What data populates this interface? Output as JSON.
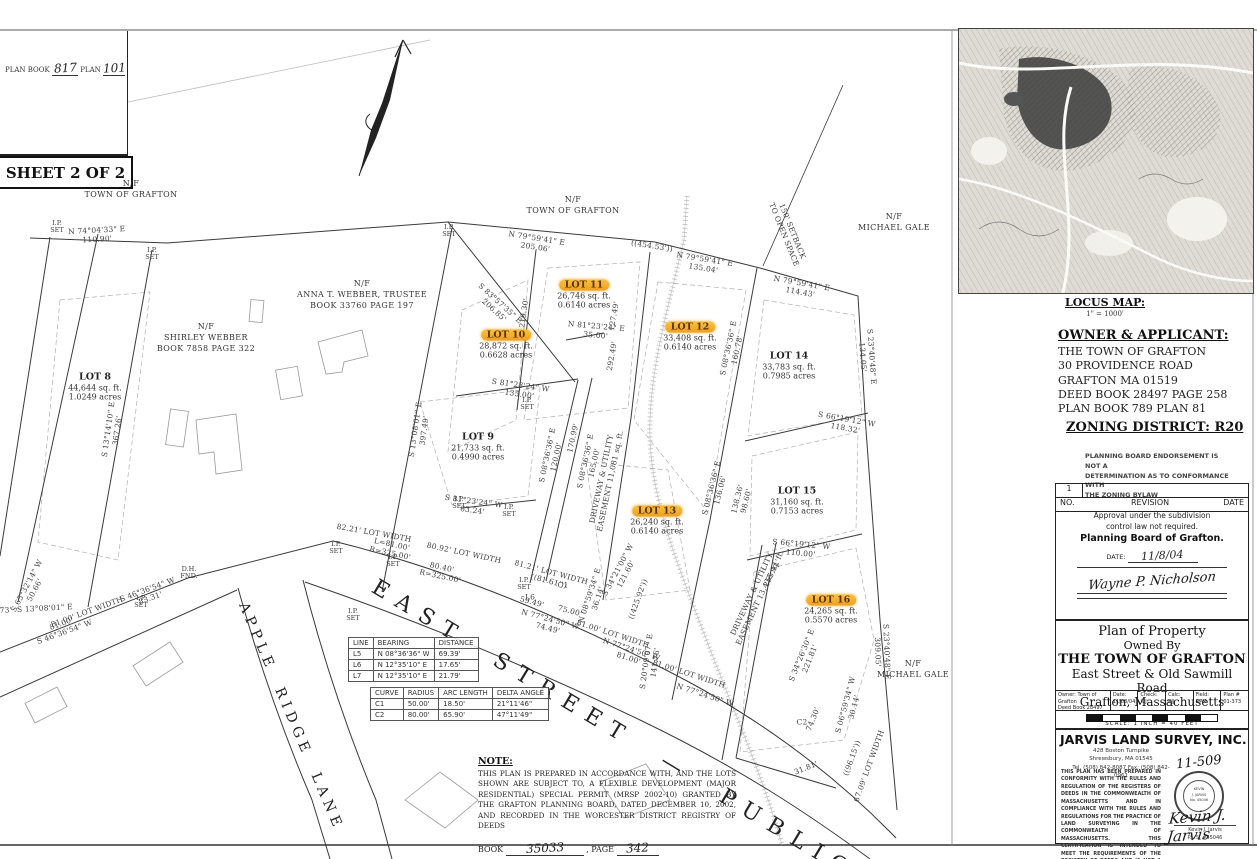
{
  "page": {
    "plan_book_label": "PLAN BOOK",
    "plan_book_value": "817",
    "plan_label": "PLAN",
    "plan_value": "101",
    "sheet_label": "SHEET 2 OF 2"
  },
  "plan": {
    "streets": {
      "east": "EAST  STREET  —  PUBLIC",
      "apple": "APPLE  RIDGE  LANE"
    },
    "lots": [
      {
        "name": "LOT 8",
        "area": "44,644 sq. ft.",
        "acres": "1.0249 acres",
        "hl": false,
        "x": 95,
        "y": 383
      },
      {
        "name": "LOT 9",
        "area": "21,733 sq. ft.",
        "acres": "0.4990 acres",
        "hl": false,
        "x": 478,
        "y": 443
      },
      {
        "name": "LOT 10",
        "area": "28,872 sq. ft.",
        "acres": "0.6628 acres",
        "hl": true,
        "x": 506,
        "y": 341
      },
      {
        "name": "LOT 11",
        "area": "26,746 sq. ft.",
        "acres": "0.6140 acres",
        "hl": true,
        "x": 584,
        "y": 291
      },
      {
        "name": "LOT 12",
        "area": "33,408 sq. ft.",
        "acres": "0.6140 acres",
        "hl": true,
        "x": 690,
        "y": 333
      },
      {
        "name": "LOT 13",
        "area": "26,240 sq. ft.",
        "acres": "0.6140 acres",
        "hl": true,
        "x": 657,
        "y": 517
      },
      {
        "name": "LOT 14",
        "area": "33,783 sq. ft.",
        "acres": "0.7985 acres",
        "hl": false,
        "x": 789,
        "y": 362
      },
      {
        "name": "LOT 15",
        "area": "31,160 sq. ft.",
        "acres": "0.7153 acres",
        "hl": false,
        "x": 797,
        "y": 497
      },
      {
        "name": "LOT 16",
        "area": "24,265 sq. ft.",
        "acres": "0.5570 acres",
        "hl": true,
        "x": 831,
        "y": 606
      }
    ],
    "abutters": [
      {
        "t": "N/F\nTOWN OF GRAFTON",
        "x": 131,
        "y": 190
      },
      {
        "t": "N/F\nTOWN OF GRAFTON",
        "x": 573,
        "y": 206
      },
      {
        "t": "N/F\nMICHAEL GALE",
        "x": 894,
        "y": 223
      },
      {
        "t": "N/F\nANNA T. WEBBER, TRUSTEE\nBOOK 33760 PAGE 197",
        "x": 362,
        "y": 295
      },
      {
        "t": "N/F\nSHIRLEY WEBBER\nBOOK 7858 PAGE 322",
        "x": 206,
        "y": 338
      },
      {
        "t": "N/F\nMICHAEL GALE",
        "x": 913,
        "y": 670
      }
    ],
    "labels": [
      {
        "t": "N 74°04'33\" E\n110.90'",
        "x": 97,
        "y": 235,
        "r": -3
      },
      {
        "t": "N 79°59'41\" E\n205.06'",
        "x": 536,
        "y": 243,
        "r": 9
      },
      {
        "t": "((454.53'))",
        "x": 652,
        "y": 246,
        "r": 9
      },
      {
        "t": "N 79°59'41\" E\n135.04'",
        "x": 704,
        "y": 264,
        "r": 9
      },
      {
        "t": "N 79°59'41\" E\n114.43'",
        "x": 801,
        "y": 288,
        "r": 10
      },
      {
        "t": "S 83°57'35\" E\n206.85'",
        "x": 497,
        "y": 307,
        "r": 42
      },
      {
        "t": "N 81°23'24\" E\n35.00'",
        "x": 596,
        "y": 331,
        "r": 5
      },
      {
        "t": "150' SETBACK\nTO OPEN SPACE",
        "x": 788,
        "y": 233,
        "r": 68
      },
      {
        "t": "S 23°40'48\" E\n134.05'",
        "x": 867,
        "y": 357,
        "r": 86
      },
      {
        "t": "S 23°40'48\" E\n309.05'",
        "x": 882,
        "y": 652,
        "r": 88
      },
      {
        "t": "S 13°14'10\" E\n367.26'",
        "x": 113,
        "y": 430,
        "r": -82
      },
      {
        "t": "S 13°08'01\" E\n397.49'",
        "x": 420,
        "y": 430,
        "r": -82
      },
      {
        "t": "219.30'",
        "x": 524,
        "y": 313,
        "r": -82
      },
      {
        "t": "127.49'",
        "x": 614,
        "y": 316,
        "r": -80
      },
      {
        "t": "292.49'",
        "x": 612,
        "y": 356,
        "r": -80
      },
      {
        "t": "S 81°23'24\" W\n135.00'",
        "x": 520,
        "y": 390,
        "r": 8
      },
      {
        "t": "S 08°36'36\" E\n120.00'",
        "x": 552,
        "y": 456,
        "r": -78
      },
      {
        "t": "170.99'",
        "x": 573,
        "y": 438,
        "r": -78
      },
      {
        "t": "S 08°36'36\" E\n165.00'",
        "x": 590,
        "y": 462,
        "r": -78
      },
      {
        "t": "DRIVEWAY & UTILITY\nEASEMENT 11,081 sq. ft.",
        "x": 606,
        "y": 480,
        "r": -78
      },
      {
        "t": "S 81°23'24\" W\n63.24'",
        "x": 473,
        "y": 506,
        "r": 8
      },
      {
        "t": "S 08°36'36\" E\n160.78'",
        "x": 733,
        "y": 349,
        "r": -78
      },
      {
        "t": "S 08°36'36\" E\n136.06'",
        "x": 716,
        "y": 489,
        "r": -76
      },
      {
        "t": "138.36'\n98.60'",
        "x": 742,
        "y": 500,
        "r": -76
      },
      {
        "t": "S 66°19'12\" W\n118.32'",
        "x": 846,
        "y": 424,
        "r": 10
      },
      {
        "t": "S 66°19'12\" W\n110.00'",
        "x": 801,
        "y": 549,
        "r": 5
      },
      {
        "t": "255.11'",
        "x": 772,
        "y": 573,
        "r": -65
      },
      {
        "t": "DRIVEWAY & UTILITY\nEASEMENT 13,435 sq. ft.",
        "x": 756,
        "y": 596,
        "r": -65
      },
      {
        "t": "S 34°21'00\" W\n121.60'",
        "x": 622,
        "y": 572,
        "r": -62
      },
      {
        "t": "S 34°26'30\" E\n221.81'",
        "x": 806,
        "y": 657,
        "r": -68
      },
      {
        "t": "74.30'",
        "x": 813,
        "y": 719,
        "r": -68
      },
      {
        "t": "S 06°59'34\" W\n30.14'",
        "x": 850,
        "y": 706,
        "r": -75
      },
      {
        "t": "((96.15'))",
        "x": 852,
        "y": 758,
        "r": -70
      },
      {
        "t": "67.09' LOT WIDTH",
        "x": 869,
        "y": 766,
        "r": -70
      },
      {
        "t": "31.81'",
        "x": 806,
        "y": 768,
        "r": -22
      },
      {
        "t": "82.21' LOT WIDTH",
        "x": 374,
        "y": 533,
        "r": 10
      },
      {
        "t": "L=81.00'\nR=325.00'",
        "x": 391,
        "y": 549,
        "r": 12
      },
      {
        "t": "80.92' LOT WIDTH",
        "x": 464,
        "y": 553,
        "r": 12
      },
      {
        "t": "80.40'\nR=325.00'",
        "x": 441,
        "y": 572,
        "r": 12
      },
      {
        "t": "81.21' LOT WIDTH\n((81.61'))",
        "x": 550,
        "y": 577,
        "r": 15
      },
      {
        "t": "59.49'",
        "x": 532,
        "y": 602,
        "r": 15
      },
      {
        "t": "N 77°24'50\" W\n74.49'",
        "x": 549,
        "y": 624,
        "r": 15
      },
      {
        "t": "75.00'",
        "x": 570,
        "y": 611,
        "r": 15
      },
      {
        "t": "81.00' LOT WIDTH",
        "x": 613,
        "y": 634,
        "r": 18
      },
      {
        "t": "N 77°24'50\" W\n81.00'",
        "x": 630,
        "y": 654,
        "r": 18
      },
      {
        "t": "81.00' LOT WIDTH",
        "x": 689,
        "y": 674,
        "r": 18
      },
      {
        "t": "N 77°24'50\" W",
        "x": 705,
        "y": 695,
        "r": 18
      },
      {
        "t": "((425.92'))",
        "x": 638,
        "y": 599,
        "r": -70
      },
      {
        "t": "S 20°09'07\" E\n141.76'",
        "x": 651,
        "y": 662,
        "r": -82
      },
      {
        "t": "N 08°59'34\" E\n36.14'",
        "x": 594,
        "y": 597,
        "r": -72
      },
      {
        "t": "S 46°36'54\" W\n83.31'",
        "x": 149,
        "y": 594,
        "r": -20
      },
      {
        "t": "81.00' LOT WIDTH",
        "x": 87,
        "y": 612,
        "r": -20
      },
      {
        "t": "81.00'\nS 46°36'54\" W",
        "x": 63,
        "y": 628,
        "r": -20
      },
      {
        "t": "S 65°32'14\" W\n50.66'",
        "x": 31,
        "y": 588,
        "r": -62
      },
      {
        "t": "34.73'  S 13°08'01\" E",
        "x": 30,
        "y": 609,
        "r": -3
      },
      {
        "t": "C1",
        "x": 563,
        "y": 585,
        "r": 0
      },
      {
        "t": "C2",
        "x": 802,
        "y": 722,
        "r": 0
      },
      {
        "t": "L6",
        "x": 530,
        "y": 597,
        "r": 0
      }
    ],
    "markers": [
      {
        "t": "I.P.\nSET",
        "x": 57,
        "y": 227
      },
      {
        "t": "I.P.\nSET",
        "x": 152,
        "y": 254
      },
      {
        "t": "I.P.\nSET",
        "x": 449,
        "y": 231
      },
      {
        "t": "I.P.\nSET",
        "x": 527,
        "y": 404
      },
      {
        "t": "I.P.\nSET",
        "x": 459,
        "y": 503
      },
      {
        "t": "I.P.\nSET",
        "x": 509,
        "y": 511
      },
      {
        "t": "I.P.\nSET",
        "x": 336,
        "y": 548
      },
      {
        "t": "I.P.\nSET",
        "x": 393,
        "y": 561
      },
      {
        "t": "I.P.\nSET",
        "x": 524,
        "y": 584
      },
      {
        "t": "I.P.\nSET",
        "x": 141,
        "y": 602
      },
      {
        "t": "I.P.\nSET",
        "x": 353,
        "y": 615
      },
      {
        "t": "D.H.\nFND.",
        "x": 189,
        "y": 573
      }
    ]
  },
  "line_table": {
    "headers": [
      "LINE",
      "BEARING",
      "DISTANCE"
    ],
    "rows": [
      [
        "L5",
        "N 08°36'36\" W",
        "69.39'"
      ],
      [
        "L6",
        "N 12°35'10\" E",
        "17.65'"
      ],
      [
        "L7",
        "N 12°35'10\" E",
        "21.79'"
      ]
    ]
  },
  "curve_table": {
    "headers": [
      "CURVE",
      "RADIUS",
      "ARC LENGTH",
      "DELTA ANGLE"
    ],
    "rows": [
      [
        "C1",
        "50.00'",
        "18.50'",
        "21°11'46\""
      ],
      [
        "C2",
        "80.00'",
        "65.90'",
        "47°11'49\""
      ]
    ]
  },
  "note": {
    "title": "NOTE:",
    "body": "THIS PLAN IS PREPARED IN ACCORDANCE WITH, AND THE LOTS SHOWN ARE SUBJECT TO, A FLEXIBLE DEVELOPMENT (MAJOR RESIDENTIAL) SPECIAL PERMIT (MRSP 2002-10) GRANTED BY THE GRAFTON PLANNING BOARD, DATED DECEMBER 10, 2002, AND RECORDED IN THE WORCESTER DISTRICT REGISTRY OF DEEDS",
    "book_label": "BOOK",
    "book_value": "35033",
    "page_label": ", PAGE",
    "page_value": "342"
  },
  "sidebar": {
    "locus": {
      "title": "LOCUS MAP:",
      "scale": "1\" = 1000'"
    },
    "owner": {
      "title": "OWNER & APPLICANT:",
      "lines": "THE TOWN OF GRAFTON\n30 PROVIDENCE ROAD\nGRAFTON MA 01519\nDEED BOOK 28497 PAGE 258\nPLAN BOOK 789 PLAN 81"
    },
    "zoning": "ZONING DISTRICT: R20",
    "disclaimer": "PLANNING BOARD ENDORSEMENT IS NOT A\nDETERMINATION AS TO CONFORMANCE WITH\nTHE ZONING BYLAW",
    "revision": {
      "row1": "1",
      "col_no": "NO.",
      "col_rev": "REVISION",
      "col_date": "DATE",
      "line1": "Approval under the subdivision",
      "line2": "control law not required.",
      "line3": "Planning Board of Grafton.",
      "date_label": "DATE:",
      "date_value": "11/8/04",
      "signature": "Wayne P. Nicholson"
    },
    "titleblock": {
      "l1": "Plan of Property",
      "l2": "Owned By",
      "l3": "THE TOWN OF GRAFTON",
      "l4": "East Street & Old Sawmill Road",
      "l5": "Grafton, Massachusetts",
      "info": [
        {
          "text": "Owner: Town of Grafton\nDeed Book 28497 Page 258"
        },
        {
          "text": "Date:\n11/08/04"
        },
        {
          "text": "Check:\nKJJ"
        },
        {
          "text": "Calc:\nKJJ"
        },
        {
          "text": "Field:\nRPM"
        },
        {
          "text": "Plan #\n01-373"
        }
      ],
      "scale_caption": "SCALE: 1 INCH = 40 FEET"
    },
    "surveyor": {
      "name": "JARVIS LAND SURVEY, INC.",
      "addr": "428 Boston Turnpike\nShrewsbury, MA 01545\nTel. (508) 842-8087 Fax: (508) 842-0961",
      "cert": "THIS PLAN HAS BEEN PREPARED IN CONFORMITY WITH THE RULES AND REGULATION OF THE REGISTERS OF DEEDS IN THE COMMONWEALTH OF MASSACHUSETTS AND IN COMPLIANCE WITH THE RULES AND REGULATIONS FOR THE PRACTICE OF LAND SURVEYING IN THE COMMONWEALTH OF MASSACHUSETTS. THIS CERTIFICATION IS INTENDED TO MEET THE REQUIREMENTS OF THE REGISTRY OF DEEDS AND IS NOT A CERTIFICATION OF THE TITLE OR OWNERSHIP OF THE LAND SHOWN HEREON.",
      "job_number": "11-509",
      "seal_text": "KEVIN\nJ. JARVIS\nNo. 45046",
      "signature": "Kevin J. Jarvis",
      "signer_name": "Kevin J. Jarvis",
      "signer_title": "P.L.S. #45046"
    }
  },
  "colors": {
    "highlight": "#f2a93b",
    "ink": "#333333",
    "paper": "#ffffff"
  }
}
